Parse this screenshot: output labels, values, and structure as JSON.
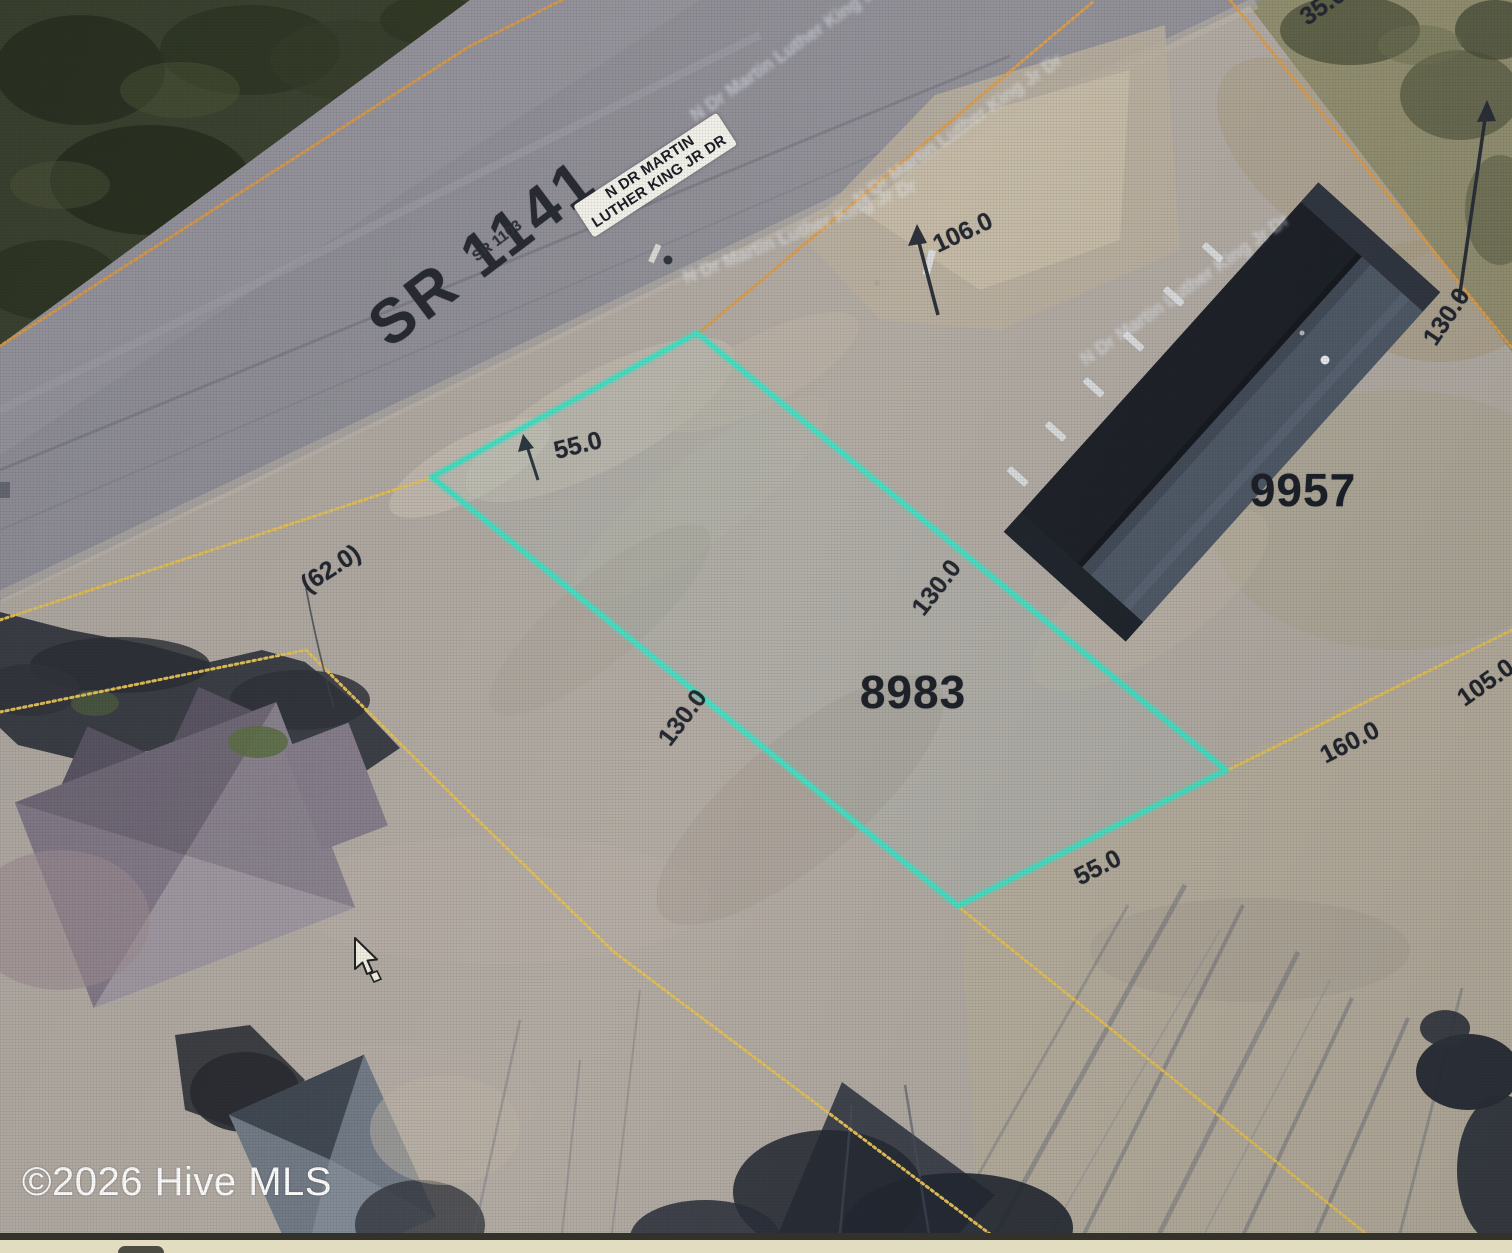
{
  "map": {
    "watermark": "©2026 Hive MLS",
    "road": {
      "route_primary": "SR 1141",
      "route_secondary": "SR 1103",
      "sign_line1": "N DR MARTIN",
      "sign_line2": "LUTHER KING JR DR",
      "ghost_label": "N Dr Martin Luther King Jr Dr"
    },
    "parcel_ids": {
      "highlighted": "8983",
      "neighbor": "9957"
    },
    "dimensions": {
      "front_55": "55.0",
      "west_paren_62": "(62.0)",
      "west_130": "130.0",
      "east_130": "130.0",
      "south_55": "55.0",
      "ne_106": "106.0",
      "ne_130": "130.0",
      "ne_35": "35.0",
      "se_160": "160.0",
      "se_105": "105.0"
    },
    "colors": {
      "highlight": "#3fe0c4",
      "parcel_line_yellow": "#e3bf52",
      "parcel_line_orange": "#dc9a44",
      "label_text": "#1d212a",
      "watermark_text": "#ffffff"
    }
  }
}
